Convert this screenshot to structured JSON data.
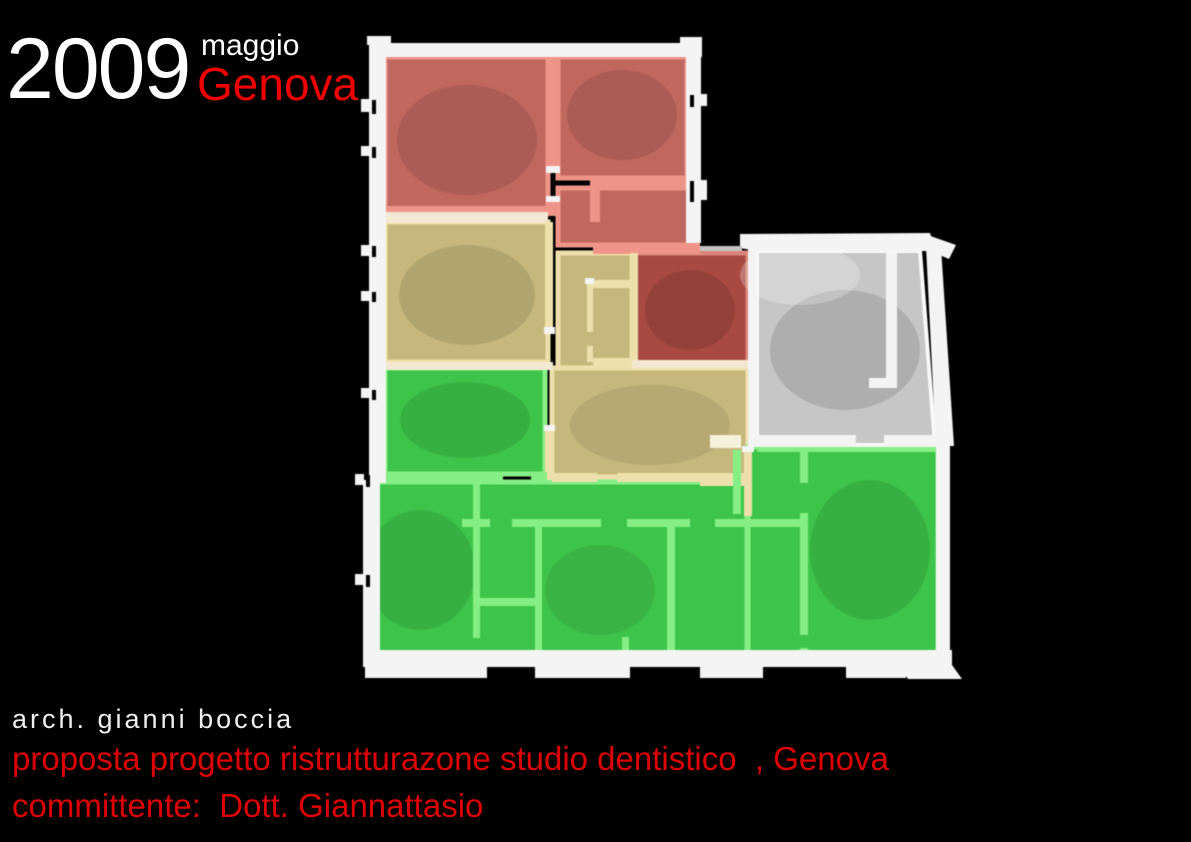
{
  "header": {
    "year": "2009",
    "month": "maggio",
    "city": "Genova"
  },
  "footer": {
    "architect": "arch. gianni boccia",
    "project": "proposta progetto ristrutturazone studio dentistico  , Genova",
    "client": "committente:  Dott. Giannattasio"
  },
  "floor_plan": {
    "type": "3d-rendered-floor-plan",
    "zones": [
      "salmon-red rooms (top)",
      "dark-red room (center)",
      "tan rooms and hall (middle)",
      "green rooms (bottom and left)",
      "gray room (right, unassigned)"
    ]
  },
  "colors": {
    "background": "#000000",
    "title_white": "#ffffff",
    "genova_red": "#ee0000",
    "footer_red": "#dd0000",
    "wall_white": "#f4f4f4",
    "salmon_room": "#c0675e",
    "salmon_wall": "#ef9488",
    "darkred_room": "#a84a41",
    "tan_room": "#c6b87c",
    "tan_wall": "#eee0ac",
    "green_room": "#3ec44a",
    "green_wall": "#85ee85",
    "gray_room": "#c6c6c6"
  }
}
